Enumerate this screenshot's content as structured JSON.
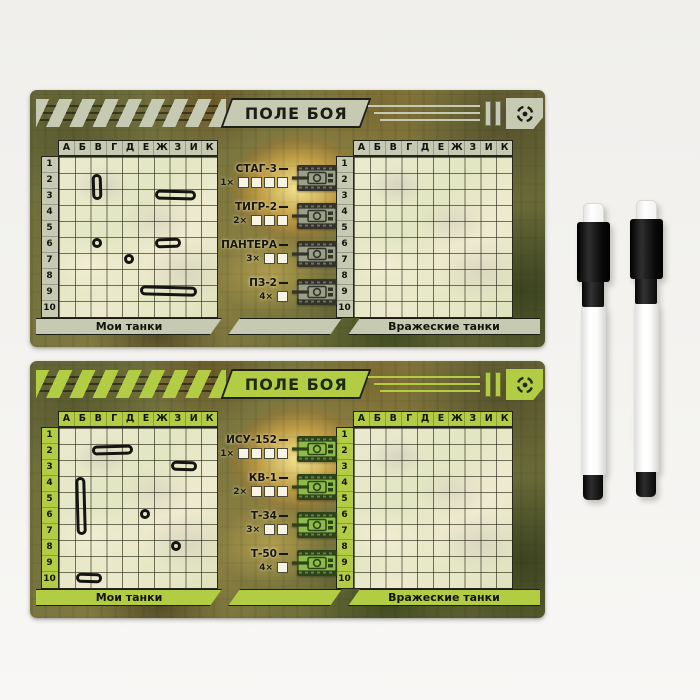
{
  "scene": {
    "background": "#f2f1ee"
  },
  "boards": [
    {
      "title": "ПОЛЕ БОЯ",
      "theme": {
        "accent": "#c6cab2",
        "ink": "#1d1d15",
        "tank_fill": "#99a087",
        "tank_dark": "#33332a",
        "mark_ink": "#141411"
      },
      "columns": [
        "А",
        "Б",
        "В",
        "Г",
        "Д",
        "Е",
        "Ж",
        "З",
        "И",
        "К"
      ],
      "rows": [
        "1",
        "2",
        "3",
        "4",
        "5",
        "6",
        "7",
        "8",
        "9",
        "10"
      ],
      "left_grid_label": "Мои танки",
      "right_grid_label": "Вражеские танки",
      "tanks": [
        {
          "name": "СТАГ-3",
          "count": "1×",
          "boxes": 4
        },
        {
          "name": "ТИГР-2",
          "count": "2×",
          "boxes": 3
        },
        {
          "name": "ПАНТЕРА",
          "count": "3×",
          "boxes": 2
        },
        {
          "name": "ПЗ-2",
          "count": "4×",
          "boxes": 1
        }
      ],
      "marks": [
        {
          "col": 3,
          "row": 2,
          "w": 1,
          "h": 2
        },
        {
          "col": 7,
          "row": 3,
          "w": 3,
          "h": 1
        },
        {
          "col": 3,
          "row": 6,
          "w": 1,
          "h": 1
        },
        {
          "col": 5,
          "row": 7,
          "w": 1,
          "h": 1
        },
        {
          "col": 7,
          "row": 6,
          "w": 2,
          "h": 1
        },
        {
          "col": 6,
          "row": 9,
          "w": 4,
          "h": 1
        }
      ]
    },
    {
      "title": "ПОЛЕ БОЯ",
      "theme": {
        "accent": "#b2cc44",
        "ink": "#1e2a0d",
        "tank_fill": "#8cbb4a",
        "tank_dark": "#2c4416",
        "mark_ink": "#141411"
      },
      "columns": [
        "А",
        "Б",
        "В",
        "Г",
        "Д",
        "Е",
        "Ж",
        "З",
        "И",
        "К"
      ],
      "rows": [
        "1",
        "2",
        "3",
        "4",
        "5",
        "6",
        "7",
        "8",
        "9",
        "10"
      ],
      "left_grid_label": "Мои танки",
      "right_grid_label": "Вражеские танки",
      "tanks": [
        {
          "name": "ИСУ-152",
          "count": "1×",
          "boxes": 4
        },
        {
          "name": "КВ-1",
          "count": "2×",
          "boxes": 3
        },
        {
          "name": "Т-34",
          "count": "3×",
          "boxes": 2
        },
        {
          "name": "Т-50",
          "count": "4×",
          "boxes": 1
        }
      ],
      "marks": [
        {
          "col": 3,
          "row": 2,
          "w": 3,
          "h": 1
        },
        {
          "col": 8,
          "row": 3,
          "w": 2,
          "h": 1
        },
        {
          "col": 2,
          "row": 4,
          "w": 1,
          "h": 4
        },
        {
          "col": 6,
          "row": 6,
          "w": 1,
          "h": 1
        },
        {
          "col": 8,
          "row": 8,
          "w": 1,
          "h": 1
        },
        {
          "col": 2,
          "row": 10,
          "w": 2,
          "h": 1
        }
      ]
    }
  ],
  "markers": {
    "items": [
      {
        "name": "dry-erase-marker"
      },
      {
        "name": "dry-erase-marker"
      }
    ],
    "body_color": "#ffffff",
    "cap_color": "#141414"
  }
}
